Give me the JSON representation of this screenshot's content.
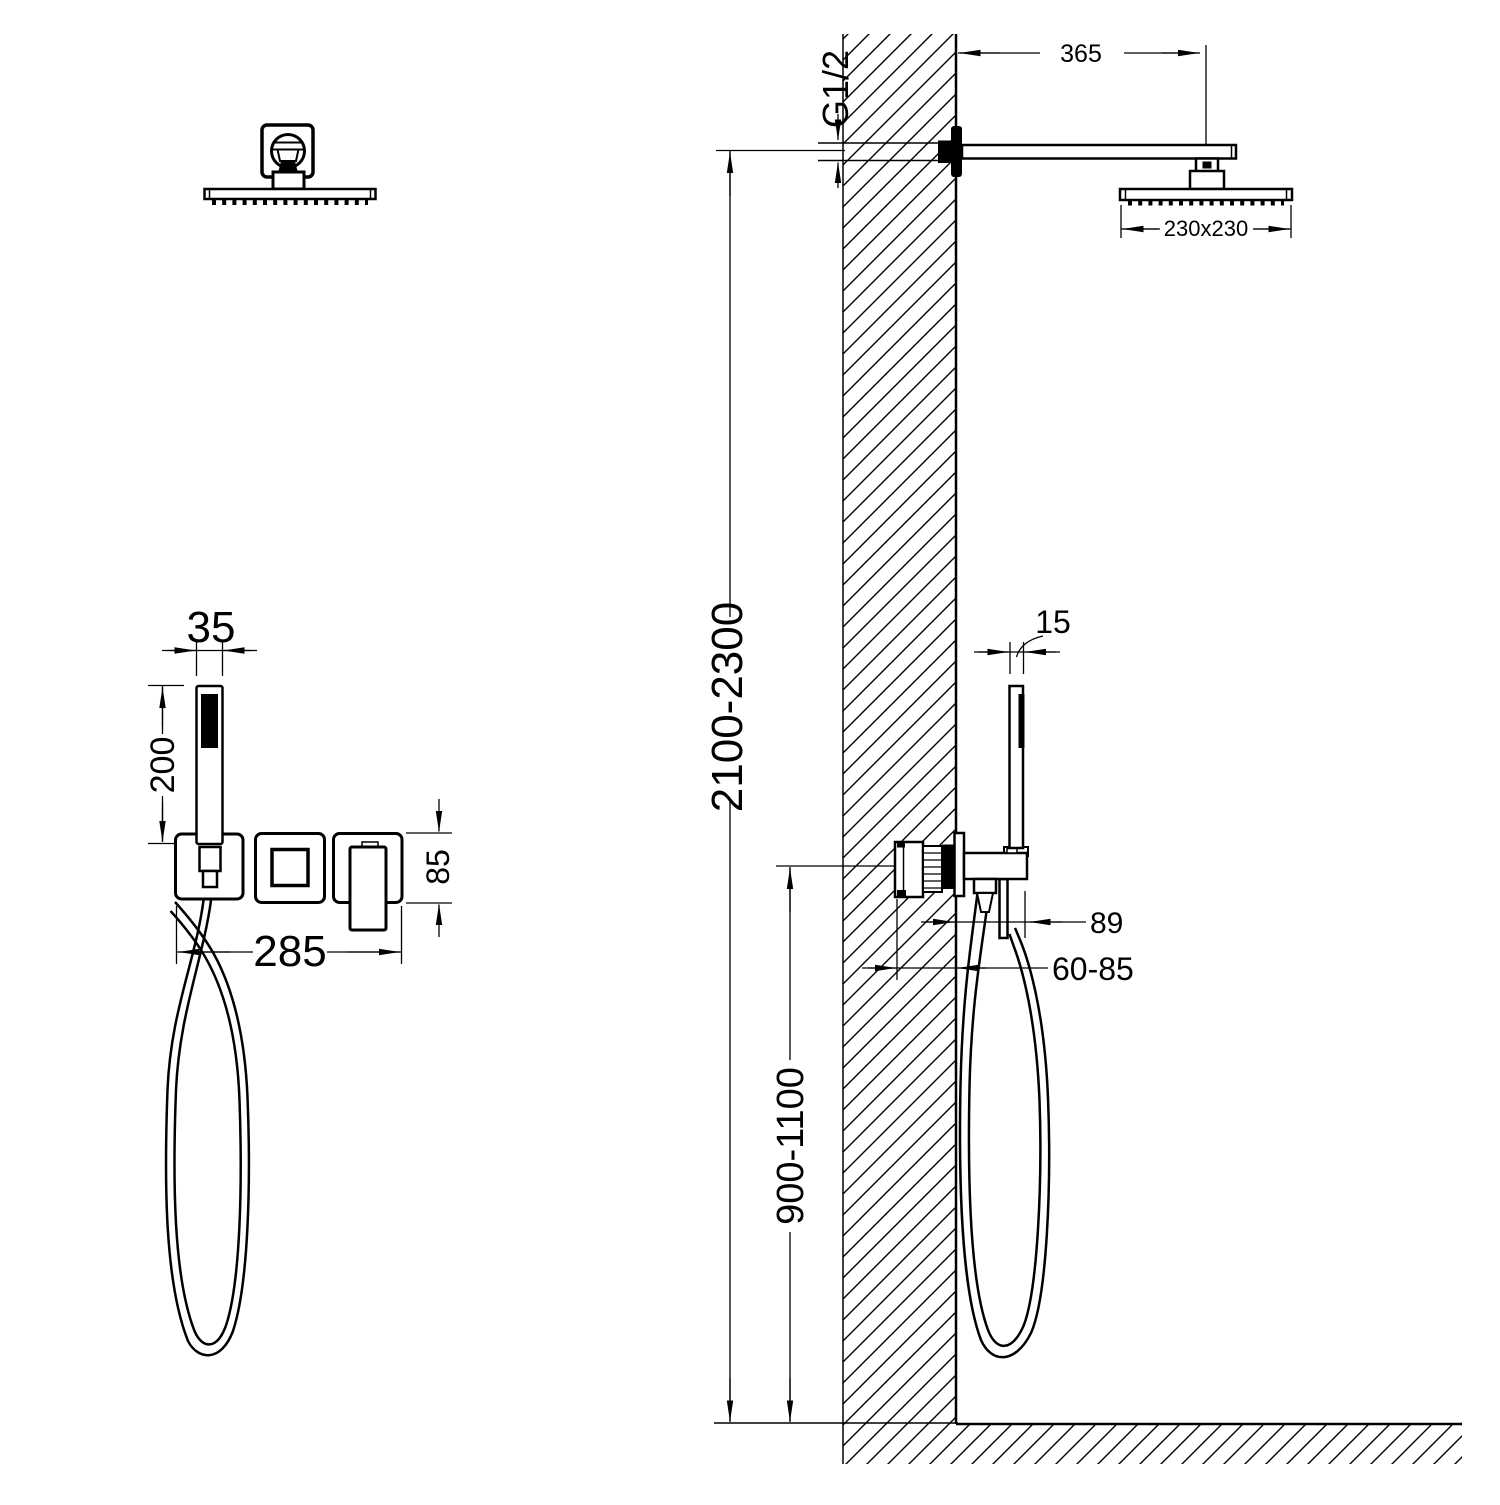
{
  "drawing": {
    "background": "#ffffff",
    "line_color": "#000000",
    "front_view": {
      "hand_shower_width": "35",
      "hand_shower_length": "200",
      "trim_set_width": "285",
      "trim_plate_height": "85"
    },
    "side_view": {
      "arm_length": "365",
      "pipe_thread": "G1/2",
      "head_size": "230x230",
      "hand_shower_depth": "15",
      "head_height_range": "2100-2300",
      "spout_projection": "89",
      "embed_depth_range": "60-85",
      "valve_height_range": "900-1100"
    }
  }
}
